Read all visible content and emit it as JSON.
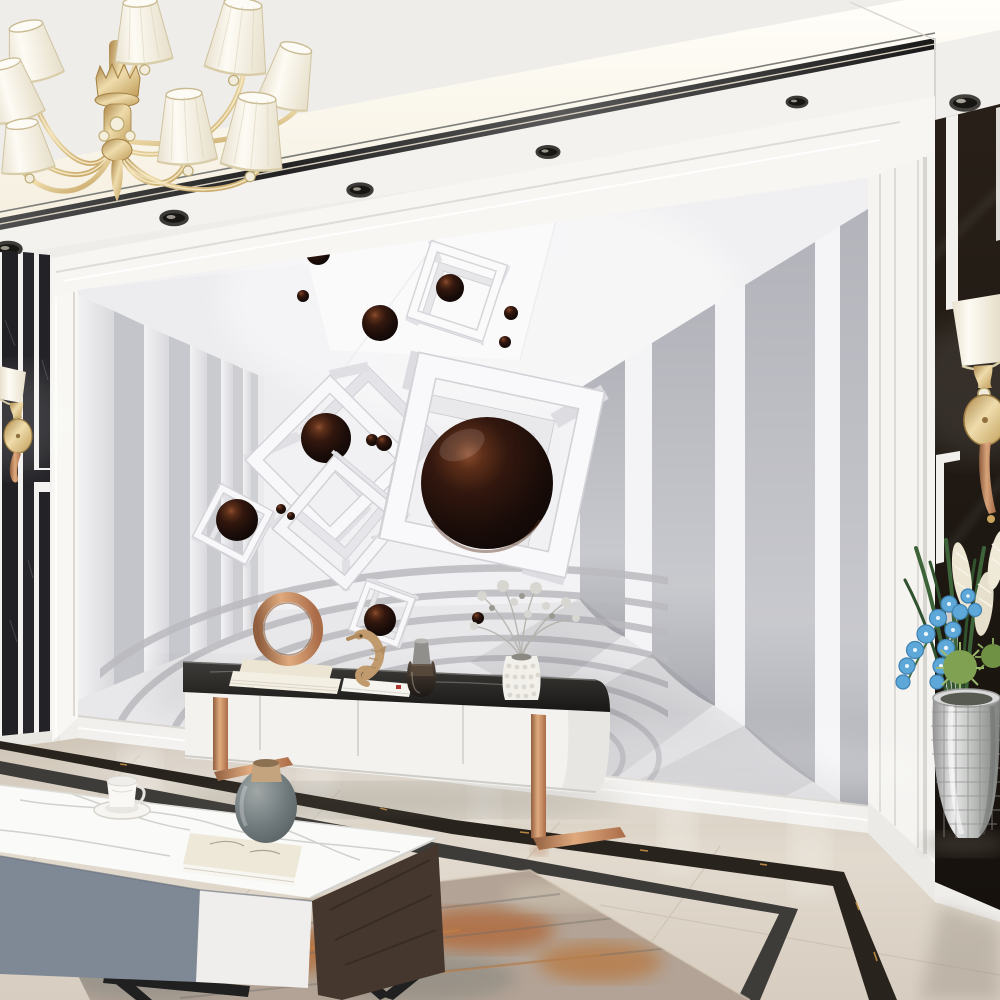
{
  "scene": {
    "type": "interior-photograph",
    "description": "Modern living room 3D render: white ceiling with gold chandelier and recessed spotlights, large 3D wall mural of white wireframe cubes and glossy dark-chocolate spheres floating in a white pillared tunnel over a rippled zen floor, white TV sideboard with black marble top and rose-gold sled legs, white marble coffee table with gray drawer, black marble accent panels with gold sconces, silver mosaic floor vase with blue orchids, polished beige marble floor with black inlay border and a distressed rust rug",
    "ceiling": {
      "base_color": "#f0eeeb",
      "cove_light": "warm recessed LED cove",
      "trim_color": "#262626",
      "spotlight_count": 6,
      "chandelier": {
        "position": "top-left",
        "finish": "polished gold",
        "shade_color": "#f8f4ea",
        "shade_count": 8,
        "crystals": true
      }
    },
    "walls": {
      "left_accent": {
        "base_color": "#f4f3f1",
        "inlay": "black marble vertical stripes",
        "stripe_color": "#1d1c20",
        "sconce": {
          "finish": "gold",
          "shade": "white cone"
        }
      },
      "mural": {
        "theme": "3D wireframe cubes with glossy spheres",
        "background_color": "#f2f2f3",
        "cube_color": "#f8f8fa",
        "cube_count": 6,
        "sphere_color": "#2a0f07",
        "sphere_count": 15,
        "sides": "receding vertical pillars",
        "floor": "concentric sand ripples"
      },
      "right_column": {
        "style": "white fluted molding",
        "color": "#f5f4f1"
      },
      "right_panel": {
        "material": "black marble",
        "color": "#18120d",
        "trim": "white geometric lines",
        "sconce": {
          "finish": "gold",
          "shade": "white cone"
        }
      }
    },
    "furniture": {
      "tv_cabinet": {
        "body_color": "#f3f2ef",
        "top": "black marble slab",
        "legs": "rose-gold sled",
        "door_count": 4,
        "decor": [
          "rose-gold ring sculpture on cream books",
          "tan seahorse figurine on white books",
          "smoked glass bottle vase",
          "white hobnail vase with silver dried bouquet"
        ]
      },
      "coffee_table": {
        "top": "white marble",
        "drawer_colors": [
          "#7d8794",
          "#efeeec"
        ],
        "side": "dark walnut",
        "legs": "black metal V",
        "items": [
          "white coffee cup with saucer",
          "gray round vase on sketchbook"
        ]
      }
    },
    "floor": {
      "material": "polished beige marble",
      "color": "#ddd3c6",
      "inlay": "double black marble border with gold veining",
      "rug": {
        "style": "distressed abstract",
        "colors": [
          "#b5682f",
          "#8f8c86",
          "#cfc4b2"
        ]
      }
    },
    "plant": {
      "vase": "silver mosaic floor vase",
      "flowers": [
        "blue orchids",
        "cream plumes",
        "green blades",
        "green spiky dahlias"
      ]
    },
    "palette": {
      "ceiling": "#f0eeeb",
      "wall_white": "#f4f3f1",
      "marble_black": "#17120e",
      "gold": "#caa35c",
      "copper": "#c58a5f",
      "floor_beige": "#ddd3c6",
      "sphere_brown": "#2a0f07",
      "rug_rust": "#b5682f",
      "orchid_blue": "#5aa7d8"
    }
  }
}
